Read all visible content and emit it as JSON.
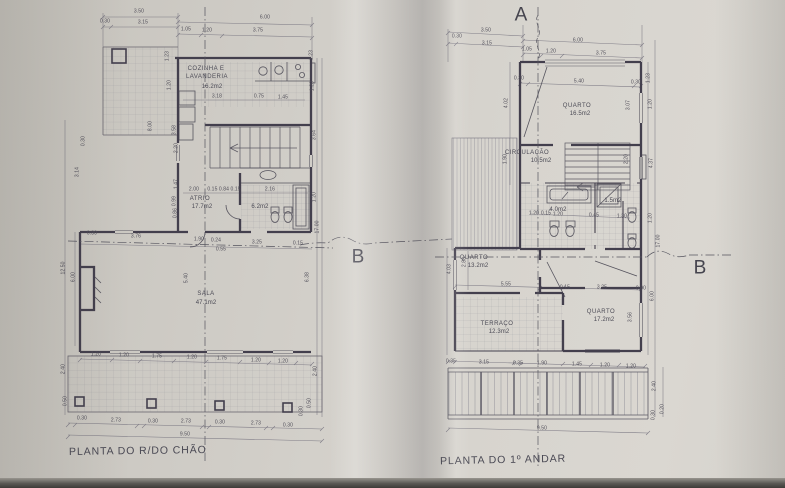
{
  "photo": {
    "paper_color": "#d3d0ca",
    "ink_color": "#4b4756",
    "thin_line_color": "#76737f"
  },
  "ground_floor": {
    "title": "PLANTA DO R/DO CHÃO",
    "rooms": [
      {
        "name": "COZINHA E LAVANDERIA",
        "area": "16.2m2"
      },
      {
        "name": "ATRIO",
        "area": "17.7m2"
      },
      {
        "name": "",
        "area": "6.2m2"
      },
      {
        "name": "SALA",
        "area": "47.1m2"
      }
    ]
  },
  "first_floor": {
    "title": "PLANTA DO 1º ANDAR",
    "rooms": [
      {
        "name": "QUARTO",
        "area": "16.5m2"
      },
      {
        "name": "CIRCULAÇÃO",
        "area": "10.5m2"
      },
      {
        "name": "",
        "area": "4.0m2"
      },
      {
        "name": "",
        "area": "1.5m2"
      },
      {
        "name": "QUARTO",
        "area": "13.2m2"
      },
      {
        "name": "TERRAÇO",
        "area": "12.3m2"
      },
      {
        "name": "QUARTO",
        "area": "17.2m2"
      }
    ]
  },
  "section_markers": [
    "A",
    "B",
    "B"
  ],
  "labels": {
    "ground": [
      {
        "t": "3.50",
        "x": 84,
        "y": 7
      },
      {
        "t": "0.30",
        "x": 50,
        "y": 17
      },
      {
        "t": "3.15",
        "x": 88,
        "y": 18
      },
      {
        "t": "6.00",
        "x": 210,
        "y": 13
      },
      {
        "t": "1.05",
        "x": 131,
        "y": 25
      },
      {
        "t": "1.20",
        "x": 152,
        "y": 26
      },
      {
        "t": "3.75",
        "x": 203,
        "y": 26
      },
      {
        "t": "1.23",
        "x": 113,
        "y": 51,
        "r": -90
      },
      {
        "t": "1.20",
        "x": 115,
        "y": 80,
        "r": -90
      },
      {
        "t": "1.23",
        "x": 257,
        "y": 50,
        "r": -90
      },
      {
        "t": "1.20",
        "x": 258,
        "y": 81,
        "r": -90
      },
      {
        "t": "3.64",
        "x": 260,
        "y": 130,
        "r": -90
      },
      {
        "t": "COZINHA E",
        "x": 151,
        "y": 64,
        "k": "room"
      },
      {
        "t": "LAVANDERIA",
        "x": 152,
        "y": 72,
        "k": "room"
      },
      {
        "t": "16.2m2",
        "x": 157,
        "y": 82,
        "k": "area"
      },
      {
        "t": "3.18",
        "x": 162,
        "y": 92
      },
      {
        "t": "0.75",
        "x": 204,
        "y": 92
      },
      {
        "t": "1.45",
        "x": 228,
        "y": 93
      },
      {
        "t": "8.00",
        "x": 96,
        "y": 121,
        "r": -90
      },
      {
        "t": "3.58",
        "x": 120,
        "y": 125,
        "r": -90
      },
      {
        "t": "2.20",
        "x": 122,
        "y": 143,
        "r": -90
      },
      {
        "t": "1.47",
        "x": 122,
        "y": 179,
        "r": -90
      },
      {
        "t": "0.99",
        "x": 120,
        "y": 196,
        "r": -90
      },
      {
        "t": "0.86",
        "x": 121,
        "y": 208,
        "r": -90
      },
      {
        "t": "3.14",
        "x": 23,
        "y": 167,
        "r": -90
      },
      {
        "t": "0.30",
        "x": 29,
        "y": 136,
        "r": -90
      },
      {
        "t": "2.00",
        "x": 139,
        "y": 185
      },
      {
        "t": "0.15 0.84 0.15",
        "x": 169,
        "y": 185
      },
      {
        "t": "2.16",
        "x": 215,
        "y": 185
      },
      {
        "t": "ATRIO",
        "x": 145,
        "y": 194,
        "k": "room"
      },
      {
        "t": "17.7m2",
        "x": 147,
        "y": 202,
        "k": "area"
      },
      {
        "t": "6.2m2",
        "x": 205,
        "y": 202,
        "k": "area"
      },
      {
        "t": "1.20",
        "x": 260,
        "y": 192,
        "r": -90
      },
      {
        "t": "0.30",
        "x": 37,
        "y": 229
      },
      {
        "t": "3.76",
        "x": 81,
        "y": 232
      },
      {
        "t": "1.90",
        "x": 144,
        "y": 235
      },
      {
        "t": "0.24",
        "x": 161,
        "y": 236
      },
      {
        "t": "3.25",
        "x": 202,
        "y": 238
      },
      {
        "t": "0.15",
        "x": 243,
        "y": 239
      },
      {
        "t": "0.55",
        "x": 166,
        "y": 245
      },
      {
        "t": "5.40",
        "x": 132,
        "y": 273,
        "r": -90
      },
      {
        "t": "6.38",
        "x": 253,
        "y": 272,
        "r": -90
      },
      {
        "t": "17.00",
        "x": 263,
        "y": 222,
        "r": -90
      },
      {
        "t": "SALA",
        "x": 151,
        "y": 289,
        "k": "room"
      },
      {
        "t": "47.1m2",
        "x": 151,
        "y": 298,
        "k": "area"
      },
      {
        "t": "12.50",
        "x": 9,
        "y": 263,
        "r": -90
      },
      {
        "t": "6.00",
        "x": 19,
        "y": 272,
        "r": -90
      },
      {
        "t": "2.40",
        "x": 9,
        "y": 364,
        "r": -90
      },
      {
        "t": "0.50",
        "x": 11,
        "y": 396,
        "r": -90
      },
      {
        "t": "1.20",
        "x": 41,
        "y": 350
      },
      {
        "t": "1.20",
        "x": 69,
        "y": 351
      },
      {
        "t": "1.75",
        "x": 102,
        "y": 352
      },
      {
        "t": "1.20",
        "x": 137,
        "y": 353
      },
      {
        "t": "1.75",
        "x": 167,
        "y": 354
      },
      {
        "t": "1.20",
        "x": 201,
        "y": 356
      },
      {
        "t": "1.20",
        "x": 228,
        "y": 357
      },
      {
        "t": "0.30",
        "x": 27,
        "y": 414
      },
      {
        "t": "2.73",
        "x": 61,
        "y": 416
      },
      {
        "t": "0.30",
        "x": 98,
        "y": 417
      },
      {
        "t": "2.73",
        "x": 131,
        "y": 417
      },
      {
        "t": "0.30",
        "x": 165,
        "y": 418
      },
      {
        "t": "2.73",
        "x": 201,
        "y": 419
      },
      {
        "t": "0.30",
        "x": 233,
        "y": 421
      },
      {
        "t": "9.50",
        "x": 130,
        "y": 430
      },
      {
        "t": "2.40",
        "x": 261,
        "y": 366,
        "r": -90
      },
      {
        "t": "0.50",
        "x": 255,
        "y": 398,
        "r": -90
      },
      {
        "t": "0.30",
        "x": 247,
        "y": 406,
        "r": -90
      }
    ],
    "first": [
      {
        "t": "A",
        "x": 86,
        "y": 10,
        "k": "marker"
      },
      {
        "t": "3.50",
        "x": 51,
        "y": 26
      },
      {
        "t": "0.30",
        "x": 22,
        "y": 32
      },
      {
        "t": "3.15",
        "x": 52,
        "y": 39
      },
      {
        "t": "6.00",
        "x": 143,
        "y": 36
      },
      {
        "t": "1.05",
        "x": 92,
        "y": 45
      },
      {
        "t": "1.20",
        "x": 116,
        "y": 47
      },
      {
        "t": "3.75",
        "x": 166,
        "y": 49
      },
      {
        "t": "0.30",
        "x": 84,
        "y": 74
      },
      {
        "t": "5.40",
        "x": 144,
        "y": 77
      },
      {
        "t": "0.30",
        "x": 201,
        "y": 78
      },
      {
        "t": "1.23",
        "x": 214,
        "y": 73,
        "r": -90
      },
      {
        "t": "1.20",
        "x": 216,
        "y": 99,
        "r": -90
      },
      {
        "t": "3.07",
        "x": 194,
        "y": 100,
        "r": -90
      },
      {
        "t": "2.20",
        "x": 192,
        "y": 154,
        "r": -90
      },
      {
        "t": "4.37",
        "x": 217,
        "y": 158,
        "r": -90
      },
      {
        "t": "1.20",
        "x": 216,
        "y": 213,
        "r": -90
      },
      {
        "t": "17.00",
        "x": 224,
        "y": 236,
        "r": -90
      },
      {
        "t": "6.00",
        "x": 218,
        "y": 291,
        "r": -90
      },
      {
        "t": "2.40",
        "x": 220,
        "y": 381,
        "r": -90
      },
      {
        "t": "0.20",
        "x": 228,
        "y": 404,
        "r": -90
      },
      {
        "t": "0.30",
        "x": 219,
        "y": 410,
        "r": -90
      },
      {
        "t": "4.02",
        "x": 72,
        "y": 98,
        "r": -90
      },
      {
        "t": "1.90",
        "x": 71,
        "y": 154,
        "r": -90
      },
      {
        "t": "4.03",
        "x": 15,
        "y": 264,
        "r": -90
      },
      {
        "t": "QUARTO",
        "x": 142,
        "y": 101,
        "k": "room"
      },
      {
        "t": "16.5m2",
        "x": 145,
        "y": 109,
        "k": "area"
      },
      {
        "t": "CIRCULAÇÃO",
        "x": 92,
        "y": 148,
        "k": "room"
      },
      {
        "t": "10.5m2",
        "x": 106,
        "y": 156,
        "k": "area"
      },
      {
        "t": "4.0m2",
        "x": 123,
        "y": 205,
        "k": "area"
      },
      {
        "t": "1.5m2",
        "x": 178,
        "y": 196,
        "k": "area"
      },
      {
        "t": "1.20",
        "x": 99,
        "y": 209
      },
      {
        "t": "0.15",
        "x": 111,
        "y": 209
      },
      {
        "t": "1.20",
        "x": 123,
        "y": 210
      },
      {
        "t": "0.45",
        "x": 159,
        "y": 211
      },
      {
        "t": "1.30",
        "x": 187,
        "y": 212
      },
      {
        "t": "QUARTO",
        "x": 39,
        "y": 253,
        "k": "room"
      },
      {
        "t": "13.2m2",
        "x": 43,
        "y": 261,
        "k": "area"
      },
      {
        "t": "2.88",
        "x": 30,
        "y": 257,
        "r": -90
      },
      {
        "t": "5.55",
        "x": 71,
        "y": 280
      },
      {
        "t": "0.15",
        "x": 130,
        "y": 283
      },
      {
        "t": "3.25",
        "x": 167,
        "y": 283
      },
      {
        "t": "0.30",
        "x": 206,
        "y": 284
      },
      {
        "t": "TERRAÇO",
        "x": 62,
        "y": 319,
        "k": "room"
      },
      {
        "t": "12.3m2",
        "x": 64,
        "y": 327,
        "k": "area"
      },
      {
        "t": "QUARTO",
        "x": 166,
        "y": 307,
        "k": "room"
      },
      {
        "t": "17.2m2",
        "x": 169,
        "y": 315,
        "k": "area"
      },
      {
        "t": "3.56",
        "x": 196,
        "y": 312,
        "r": -90
      },
      {
        "t": "B",
        "x": 265,
        "y": 263,
        "k": "marker"
      },
      {
        "t": "0.35",
        "x": 16,
        "y": 357
      },
      {
        "t": "3.15",
        "x": 49,
        "y": 358
      },
      {
        "t": "0.35",
        "x": 83,
        "y": 359
      },
      {
        "t": "1.90",
        "x": 107,
        "y": 359
      },
      {
        "t": "1.45",
        "x": 142,
        "y": 360
      },
      {
        "t": "1.20",
        "x": 170,
        "y": 361
      },
      {
        "t": "1.20",
        "x": 196,
        "y": 362
      },
      {
        "t": "9.50",
        "x": 107,
        "y": 424
      }
    ],
    "between": [
      {
        "t": "B",
        "x": 358,
        "y": 257,
        "k": "marker"
      }
    ]
  }
}
